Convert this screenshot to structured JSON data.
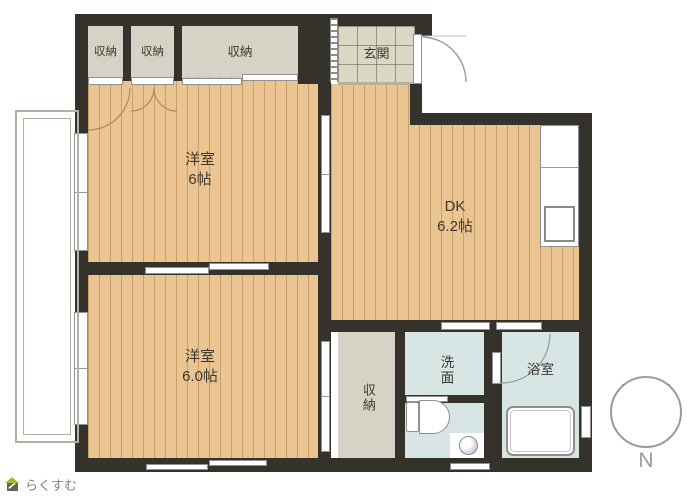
{
  "plan_title": "floor-plan",
  "rooms": {
    "closet_top_left": {
      "label": "収納"
    },
    "closet_top_mid": {
      "label": "収納"
    },
    "closet_top_wide": {
      "label": "収納"
    },
    "entrance": {
      "label": "玄関"
    },
    "western_room_1": {
      "label": "洋室",
      "size": "6帖"
    },
    "dining_kitchen": {
      "label": "DK",
      "size": "6.2帖"
    },
    "western_room_2": {
      "label": "洋室",
      "size": "6.0帖"
    },
    "closet_bottom": {
      "label": "収納"
    },
    "washroom": {
      "label": "洗面"
    },
    "bathroom": {
      "label": "浴室"
    }
  },
  "compass": {
    "label": "N"
  },
  "logo": {
    "text": "らくすむ"
  },
  "colors": {
    "wall": "#35322c",
    "wood_floor": "#ebc591",
    "tile_floor": "#dbd7c5",
    "wet_floor": "#d7e5e4",
    "closet_floor": "#d6d2c5",
    "fixture_line": "#8f8f8f",
    "logo_green": "#9bbf30"
  }
}
